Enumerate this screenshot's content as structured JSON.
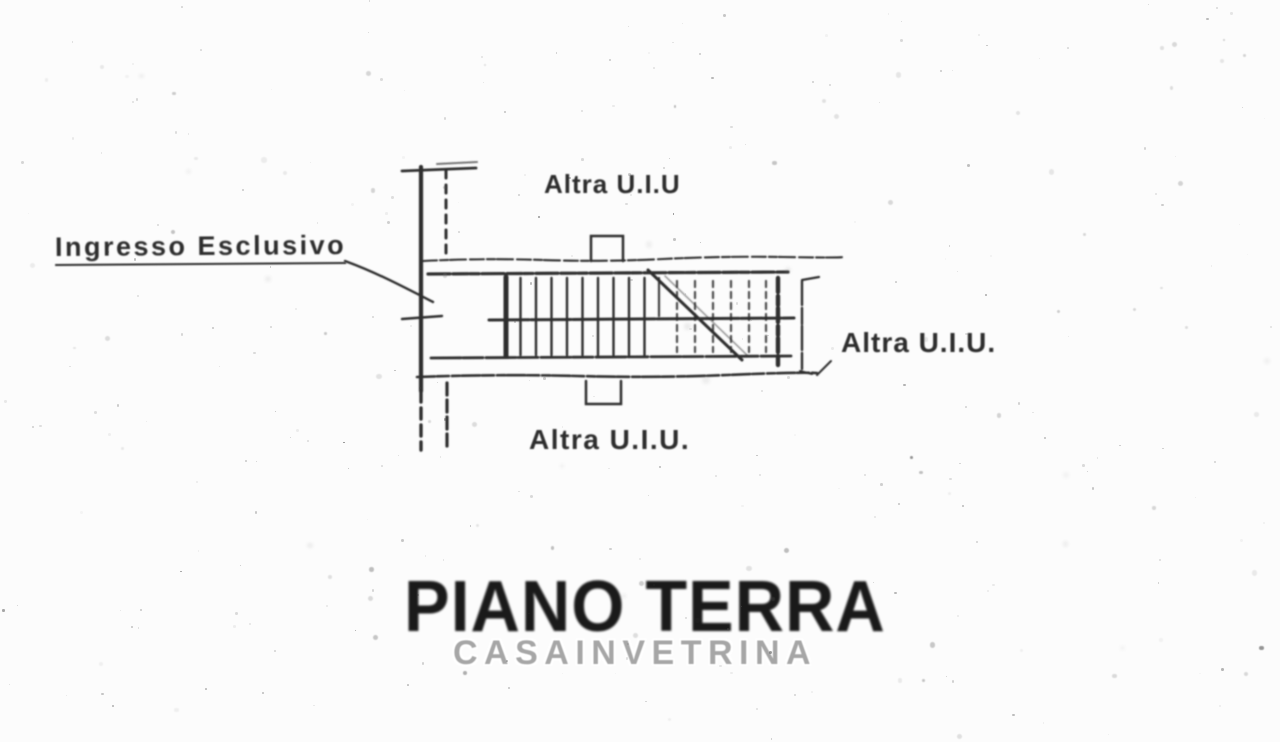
{
  "colors": {
    "background": "#fcfcfc",
    "ink": "#2d2d2d",
    "title_ink": "#1a1a1a",
    "watermark_gray": "#a6a6a6"
  },
  "plan": {
    "labels": {
      "top_unit": "Altra U.I.U",
      "right_unit": "Altra U.I.U.",
      "bottom_unit": "Altra U.I.U.",
      "entrance": "Ingresso Esclusivo"
    },
    "title": "PIANO TERRA",
    "watermark": "CASAINVETRINA"
  }
}
